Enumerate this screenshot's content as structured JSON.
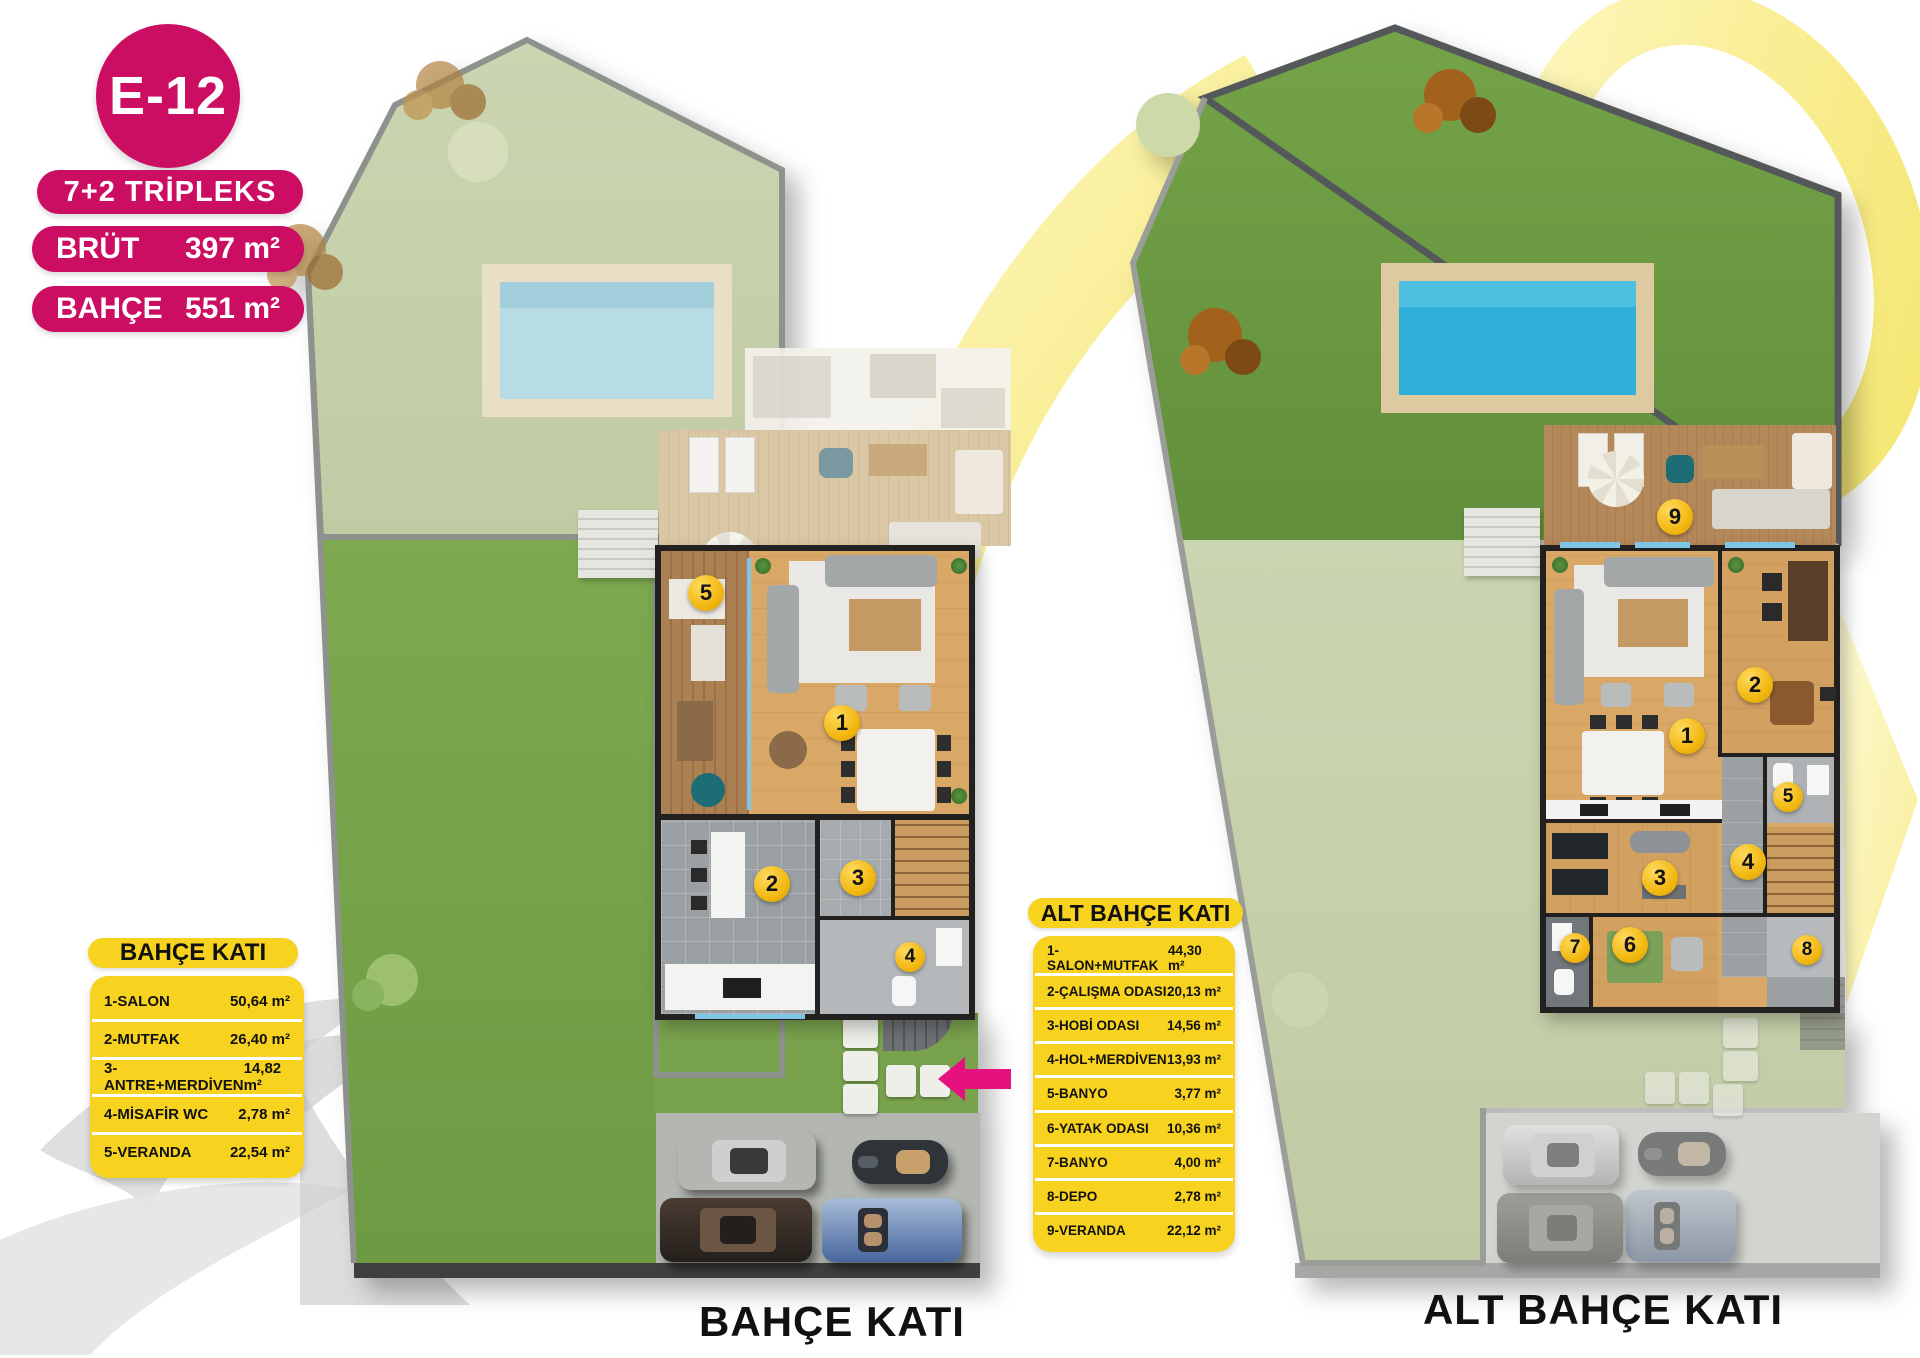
{
  "unit_badge": {
    "code": "E-12"
  },
  "unit_specs": {
    "type": "7+2 TRİPLEKS",
    "brut_label": "BRÜT",
    "brut_value": "397 m²",
    "bahce_label": "BAHÇE",
    "bahce_value": "551 m²"
  },
  "garden_floor": {
    "caption": "BAHÇE KATI",
    "legend_title": "BAHÇE KATI",
    "rooms": [
      {
        "name": "1-SALON",
        "area": "50,64 m²"
      },
      {
        "name": "2-MUTFAK",
        "area": "26,40 m²"
      },
      {
        "name": "3-ANTRE+MERDİVEN",
        "area": "14,82 m²"
      },
      {
        "name": "4-MİSAFİR WC",
        "area": "2,78 m²"
      },
      {
        "name": "5-VERANDA",
        "area": "22,54 m²"
      }
    ],
    "markers": [
      "1",
      "2",
      "3",
      "4",
      "5"
    ]
  },
  "lower_garden_floor": {
    "caption": "ALT BAHÇE KATI",
    "legend_title": "ALT BAHÇE KATI",
    "rooms": [
      {
        "name": "1-SALON+MUTFAK",
        "area": "44,30 m²"
      },
      {
        "name": "2-ÇALIŞMA ODASI",
        "area": "20,13 m²"
      },
      {
        "name": "3-HOBİ ODASI",
        "area": "14,56 m²"
      },
      {
        "name": "4-HOL+MERDİVEN",
        "area": "13,93 m²"
      },
      {
        "name": "5-BANYO",
        "area": "3,77 m²"
      },
      {
        "name": "6-YATAK ODASI",
        "area": "10,36 m²"
      },
      {
        "name": "7-BANYO",
        "area": "4,00 m²"
      },
      {
        "name": "8-DEPO",
        "area": "2,78 m²"
      },
      {
        "name": "9-VERANDA",
        "area": "22,12 m²"
      }
    ],
    "markers": [
      "1",
      "2",
      "3",
      "4",
      "5",
      "6",
      "7",
      "8",
      "9"
    ]
  },
  "colors": {
    "brand_pink": "#cb0e62",
    "arrow_pink": "#e5127d",
    "legend_yellow": "#f7d21e",
    "marker_gold": "#f2b70f"
  }
}
